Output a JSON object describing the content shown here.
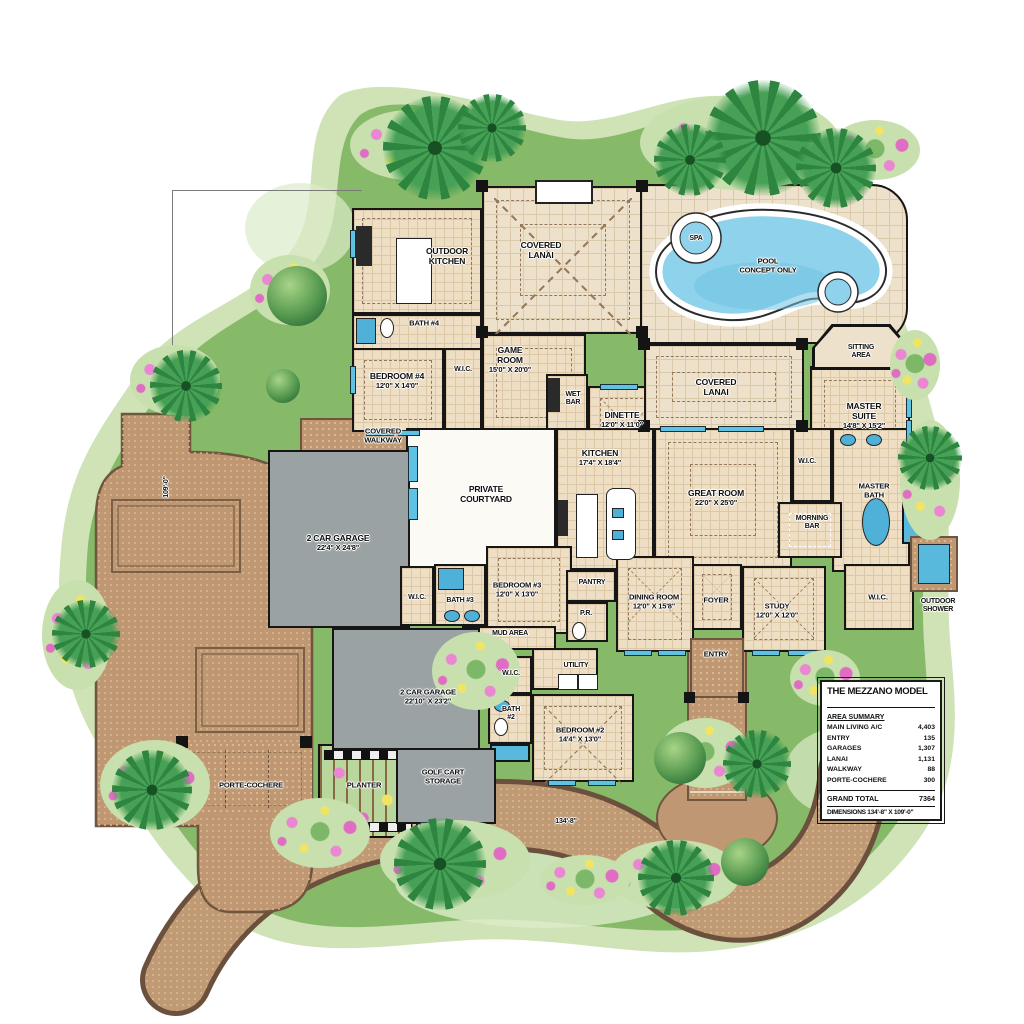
{
  "colors": {
    "grass": "#86b968",
    "grass_light": "#cfe3b6",
    "paver": "#bf9873",
    "road_edge": "#6b513d",
    "floor": "#eedec4",
    "garage_floor": "#9aa2a3",
    "pool_water": "#8ed2ec",
    "wall_black": "#161616",
    "water_accent": "#58b9dc"
  },
  "site": {
    "pool": {
      "name": "POOL\nCONCEPT ONLY"
    },
    "spa": {
      "name": "SPA"
    },
    "planter": {
      "name": "PLANTER"
    },
    "porte_cochere": {
      "name": "PORTE-COCHERE"
    },
    "outdoor_shower": {
      "name": "OUTDOOR\nSHOWER"
    },
    "dim_width": "134'-8\"",
    "dim_height": "109'-0\""
  },
  "rooms": {
    "outdoor_kitchen": {
      "name": "OUTDOOR\nKITCHEN"
    },
    "covered_lanai_top": {
      "name": "COVERED\nLANAI"
    },
    "bath4": {
      "name": "BATH #4"
    },
    "game_room": {
      "name": "GAME\nROOM",
      "dims": "15'0\" X 20'0\""
    },
    "bedroom4": {
      "name": "BEDROOM #4",
      "dims": "12'0\" X 14'0\""
    },
    "wic4": {
      "name": "W.I.C."
    },
    "wet_bar": {
      "name": "WET\nBAR"
    },
    "dinette": {
      "name": "DINETTE",
      "dims": "12'0\" X 11'0\""
    },
    "covered_lanai_right": {
      "name": "COVERED\nLANAI"
    },
    "sitting_area": {
      "name": "SITTING\nAREA"
    },
    "master_suite": {
      "name": "MASTER\nSUITE",
      "dims": "14'8\" X 15'2\""
    },
    "covered_walkway": {
      "name": "COVERED\nWALKWAY"
    },
    "private_courtyard": {
      "name": "PRIVATE\nCOURTYARD"
    },
    "kitchen": {
      "name": "KITCHEN",
      "dims": "17'4\" X 18'4\""
    },
    "great_room": {
      "name": "GREAT ROOM",
      "dims": "22'0\" X 25'0\""
    },
    "wic_hall": {
      "name": "W.I.C."
    },
    "master_bath": {
      "name": "MASTER\nBATH"
    },
    "morning_bar": {
      "name": "MORNING\nBAR"
    },
    "wic_master": {
      "name": "W.I.C."
    },
    "garage1": {
      "name": "2 CAR GARAGE",
      "dims": "22'4\" X 24'8\""
    },
    "wic3": {
      "name": "W.I.C."
    },
    "bath3": {
      "name": "BATH #3"
    },
    "bedroom3": {
      "name": "BEDROOM #3",
      "dims": "12'0\" X 13'0\""
    },
    "mud_area": {
      "name": "MUD AREA"
    },
    "pantry": {
      "name": "PANTRY"
    },
    "powder_room": {
      "name": "P.R."
    },
    "dining_room": {
      "name": "DINING ROOM",
      "dims": "12'0\" X 15'8\""
    },
    "foyer": {
      "name": "FOYER"
    },
    "study": {
      "name": "STUDY",
      "dims": "12'0\" X 12'0\""
    },
    "entry": {
      "name": "ENTRY"
    },
    "utility": {
      "name": "UTILITY"
    },
    "wic2": {
      "name": "W.I.C."
    },
    "bath2": {
      "name": "BATH\n#2"
    },
    "bedroom2": {
      "name": "BEDROOM #2",
      "dims": "14'4\" X 13'0\""
    },
    "garage2": {
      "name": "2 CAR GARAGE",
      "dims": "22'10\" X 23'2\""
    },
    "golf_cart": {
      "name": "GOLF CART\nSTORAGE"
    }
  },
  "title_block": {
    "title": "THE MEZZANO MODEL",
    "summary_heading": "AREA SUMMARY",
    "rows": [
      {
        "label": "MAIN LIVING A/C",
        "value": "4,403"
      },
      {
        "label": "ENTRY",
        "value": "135"
      },
      {
        "label": "GARAGES",
        "value": "1,307"
      },
      {
        "label": "LANAI",
        "value": "1,131"
      },
      {
        "label": "WALKWAY",
        "value": "88"
      },
      {
        "label": "PORTE-COCHERE",
        "value": "300"
      }
    ],
    "total_label": "GRAND TOTAL",
    "total_value": "7364",
    "dimensions": "DIMENSIONS 134'-8\" X 109'-0\""
  }
}
